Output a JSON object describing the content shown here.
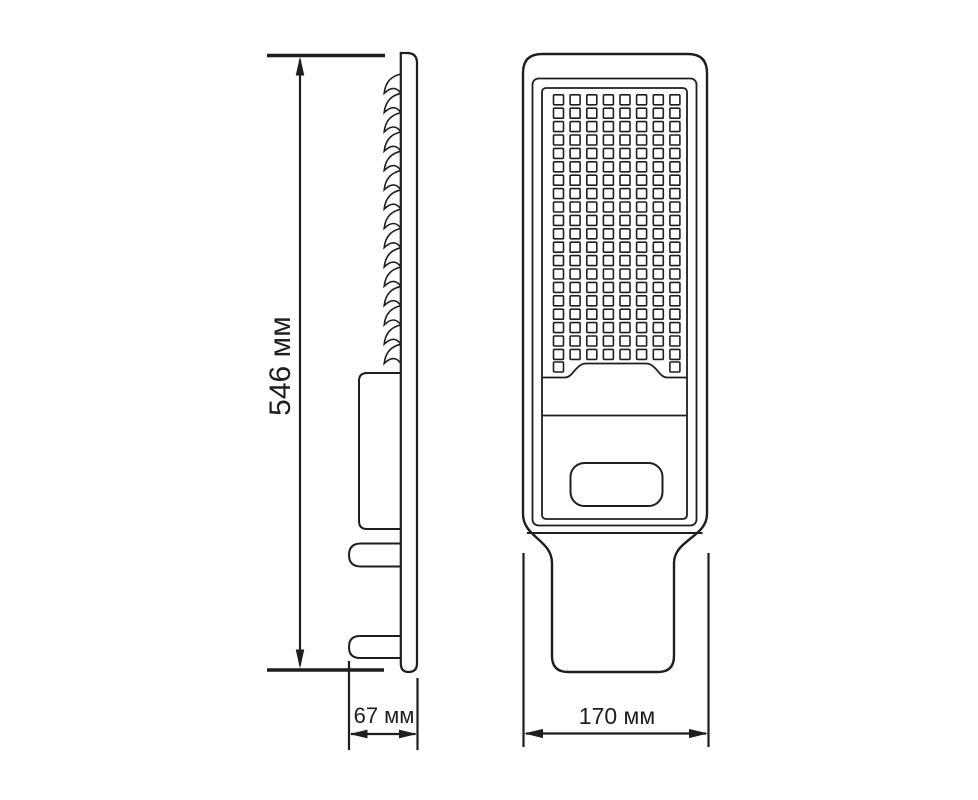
{
  "meta": {
    "title": "Street light luminaire dimensional drawing",
    "background_color": "#ffffff",
    "line_color": "#1e1e1e"
  },
  "dimensions": {
    "height": {
      "label": "546 мм"
    },
    "depth": {
      "label": "67 мм"
    },
    "width": {
      "label": "170 мм"
    }
  },
  "side_view": {
    "heat_sink_fin_count": 15,
    "mounting_tab_count": 2
  },
  "front_view": {
    "led_grid": {
      "columns": 8,
      "full_rows": 20,
      "bottom_corner_leds": 2,
      "total_leds": 162
    }
  }
}
